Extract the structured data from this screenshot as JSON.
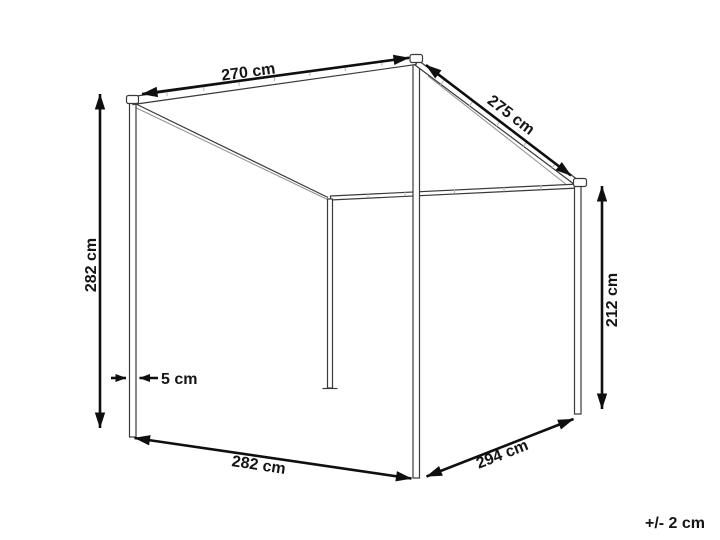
{
  "diagram": {
    "dimensions": {
      "top_front_width": "270 cm",
      "roof_slope_depth": "275 cm",
      "front_post_height": "282 cm",
      "back_post_height": "212 cm",
      "post_thickness": "5 cm",
      "bottom_front_width": "282 cm",
      "bottom_side_depth": "294 cm"
    },
    "tolerance_note": "+/- 2 cm",
    "colors": {
      "background": "#ffffff",
      "dimension_line": "#0f0f0f",
      "structure_line": "#3a3a3a",
      "tick_mark": "#b3b3b3",
      "label_text": "#151515"
    }
  }
}
